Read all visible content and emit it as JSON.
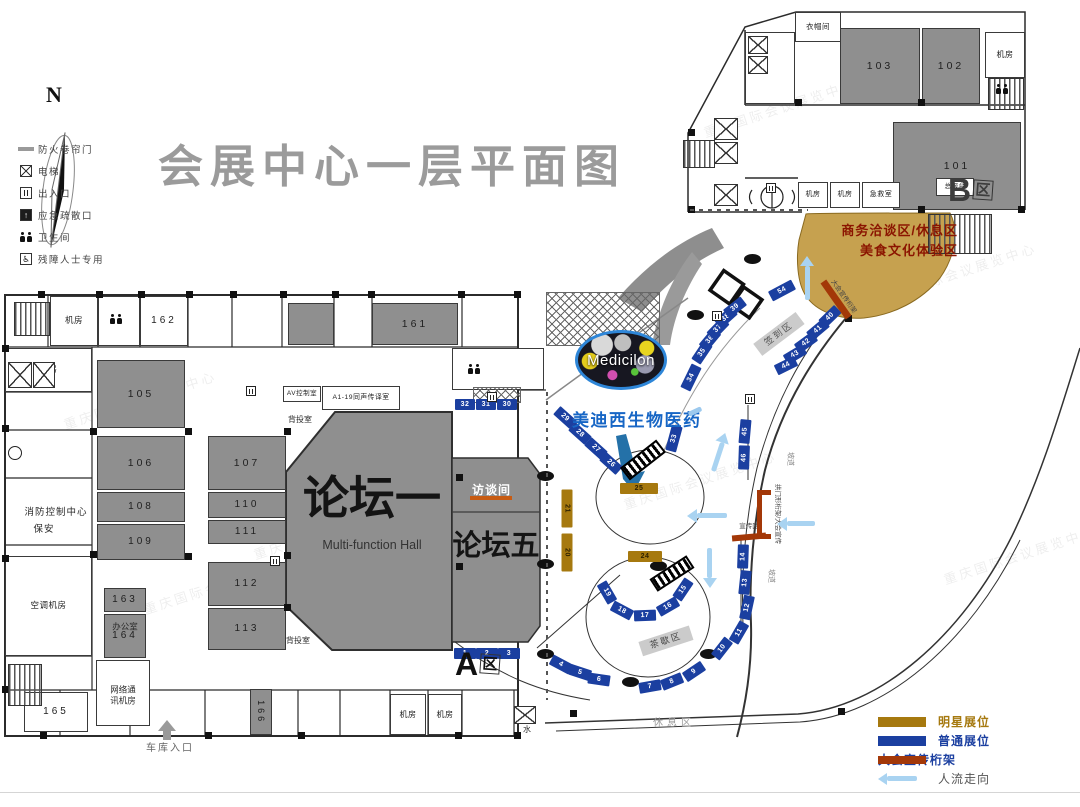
{
  "title": "会展中心一层平面图",
  "compass": {
    "label": "N"
  },
  "watermark": "重庆国际会议展览中心",
  "legend": {
    "items": [
      {
        "icon": "fire-shutter-icon",
        "label": "防火卷帘门"
      },
      {
        "icon": "elevator-icon",
        "label": "电梯"
      },
      {
        "icon": "entrance-icon",
        "label": "出入口"
      },
      {
        "icon": "emergency-exit-icon",
        "label": "应急疏散口"
      },
      {
        "icon": "restroom-icon",
        "label": "卫生间"
      },
      {
        "icon": "accessible-icon",
        "label": "残障人士专用"
      }
    ]
  },
  "booth_legend": {
    "items": [
      {
        "swatch": "star",
        "label": "明星展位"
      },
      {
        "swatch": "normal",
        "label": "普通展位"
      },
      {
        "swatch": "truss",
        "label": "大会宣传桁架"
      },
      {
        "swatch": "flow",
        "label": "人流走向"
      }
    ]
  },
  "halls": {
    "forum_one": "论坛一",
    "forum_one_en": "Multi-function Hall",
    "forum_five": "论坛五",
    "interview_room": "访谈间",
    "zone_a": "A",
    "zone_a_suffix": "区",
    "zone_b": "B",
    "zone_b_suffix": "区"
  },
  "areas": {
    "business_lounge": "商务洽谈区/休息区",
    "food_culture": "美食文化体验区"
  },
  "medicilon": {
    "logo_text": "Medicilon",
    "caption": "美迪西生物医药"
  },
  "colors": {
    "booth_normal": "#1B3FA0",
    "booth_star": "#A6790F",
    "truss_red": "#A33808",
    "flow_arrow_blue": "#A9D3F1",
    "lounge_tan": "#C6A14F",
    "room_gray": "#8F8F8F",
    "title_gray": "#9B9B9B",
    "interview_underline": "#C75B12",
    "medicilon_blue": "#1766C5",
    "lounge_text_red": "#8B1500"
  },
  "rooms": {
    "items": [
      {
        "label": "105",
        "x": 97,
        "y": 360,
        "w": 88,
        "h": 68,
        "kind": "g"
      },
      {
        "label": "106",
        "x": 97,
        "y": 436,
        "w": 88,
        "h": 54,
        "kind": "g"
      },
      {
        "label": "108",
        "x": 97,
        "y": 492,
        "w": 88,
        "h": 30,
        "kind": "g",
        "fs": 10
      },
      {
        "label": "109",
        "x": 97,
        "y": 524,
        "w": 88,
        "h": 36,
        "kind": "g",
        "fs": 10
      },
      {
        "label": "107",
        "x": 208,
        "y": 436,
        "w": 78,
        "h": 54,
        "kind": "g"
      },
      {
        "label": "110",
        "x": 208,
        "y": 492,
        "w": 78,
        "h": 26,
        "kind": "g",
        "fs": 10
      },
      {
        "label": "111",
        "x": 208,
        "y": 520,
        "w": 78,
        "h": 24,
        "kind": "g",
        "fs": 10
      },
      {
        "label": "112",
        "x": 208,
        "y": 562,
        "w": 78,
        "h": 44,
        "kind": "g",
        "fs": 10
      },
      {
        "label": "113",
        "x": 208,
        "y": 608,
        "w": 78,
        "h": 42,
        "kind": "g",
        "fs": 10
      },
      {
        "label": "161",
        "x": 372,
        "y": 303,
        "w": 86,
        "h": 42,
        "kind": "g"
      },
      {
        "label": "",
        "x": 288,
        "y": 303,
        "w": 46,
        "h": 42,
        "kind": "g"
      },
      {
        "label": "163",
        "x": 104,
        "y": 588,
        "w": 42,
        "h": 24,
        "kind": "g",
        "fs": 10
      },
      {
        "label": "164",
        "x": 104,
        "y": 614,
        "w": 42,
        "h": 44,
        "kind": "g",
        "fs": 10
      },
      {
        "label": "166",
        "x": 250,
        "y": 689,
        "w": 22,
        "h": 46,
        "kind": "g",
        "fs": 9,
        "rot": 90
      },
      {
        "label": "101",
        "x": 893,
        "y": 122,
        "w": 128,
        "h": 88,
        "kind": "g"
      },
      {
        "label": "102",
        "x": 922,
        "y": 28,
        "w": 58,
        "h": 76,
        "kind": "g"
      },
      {
        "label": "103",
        "x": 840,
        "y": 28,
        "w": 80,
        "h": 76,
        "kind": "g"
      },
      {
        "label": "",
        "x": 458,
        "y": 350,
        "w": 56,
        "h": 15,
        "kind": "g"
      },
      {
        "label": "机房",
        "x": 50,
        "y": 296,
        "w": 48,
        "h": 50,
        "kind": "w",
        "fs": 8.5
      },
      {
        "label": "",
        "x": 98,
        "y": 296,
        "w": 42,
        "h": 50,
        "kind": "w"
      },
      {
        "label": "162",
        "x": 140,
        "y": 296,
        "w": 48,
        "h": 50,
        "kind": "w",
        "fs": 10
      },
      {
        "label": "库房",
        "x": 5,
        "y": 348,
        "w": 87,
        "h": 44,
        "kind": "w",
        "fs": 8.5
      },
      {
        "label": "空调机房",
        "x": 5,
        "y": 556,
        "w": 87,
        "h": 100,
        "kind": "w",
        "fs": 8.5
      },
      {
        "label": "AV控制室",
        "x": 283,
        "y": 386,
        "w": 38,
        "h": 16,
        "kind": "w",
        "fs": 6.5
      },
      {
        "label": "A1-19同声传译室",
        "x": 322,
        "y": 386,
        "w": 78,
        "h": 24,
        "kind": "w",
        "fs": 6.8
      },
      {
        "label": "",
        "x": 96,
        "y": 660,
        "w": 54,
        "h": 66,
        "kind": "w"
      },
      {
        "label": "165",
        "x": 24,
        "y": 692,
        "w": 64,
        "h": 40,
        "kind": "w",
        "fs": 10
      },
      {
        "label": "",
        "x": 452,
        "y": 348,
        "w": 92,
        "h": 42,
        "kind": "w"
      },
      {
        "label": "衣帽间",
        "x": 795,
        "y": 12,
        "w": 46,
        "h": 30,
        "kind": "w",
        "fs": 7.5
      },
      {
        "label": "机房",
        "x": 985,
        "y": 32,
        "w": 40,
        "h": 46,
        "kind": "w",
        "fs": 8
      },
      {
        "label": "机房",
        "x": 798,
        "y": 182,
        "w": 30,
        "h": 26,
        "kind": "w",
        "fs": 7
      },
      {
        "label": "机房",
        "x": 830,
        "y": 182,
        "w": 30,
        "h": 26,
        "kind": "w",
        "fs": 7
      },
      {
        "label": "急救室",
        "x": 862,
        "y": 182,
        "w": 38,
        "h": 26,
        "kind": "w",
        "fs": 7
      },
      {
        "label": "总服台",
        "x": 936,
        "y": 178,
        "w": 38,
        "h": 18,
        "kind": "w",
        "fs": 6.5
      },
      {
        "label": "机房",
        "x": 390,
        "y": 694,
        "w": 36,
        "h": 41,
        "kind": "w",
        "fs": 8
      },
      {
        "label": "机房",
        "x": 428,
        "y": 694,
        "w": 34,
        "h": 41,
        "kind": "w",
        "fs": 8
      },
      {
        "label": "",
        "x": 745,
        "y": 32,
        "w": 50,
        "h": 72,
        "kind": "w"
      }
    ]
  },
  "labels": {
    "items": [
      {
        "text": "消防控制中心",
        "x": 56,
        "y": 513,
        "fs": 9.5,
        "ls": 1
      },
      {
        "text": "保安",
        "x": 44,
        "y": 530,
        "fs": 9.5,
        "ls": 1
      },
      {
        "text": "背投室",
        "x": 300,
        "y": 420,
        "fs": 8
      },
      {
        "text": "背投室",
        "x": 298,
        "y": 641,
        "fs": 8
      },
      {
        "text": "办公室",
        "x": 125,
        "y": 627,
        "fs": 8.5
      },
      {
        "text": "网络通讯机房",
        "x": 123,
        "y": 695,
        "fs": 8.5,
        "w": 32,
        "wrap": true
      },
      {
        "text": "水",
        "x": 527,
        "y": 730,
        "fs": 8
      },
      {
        "text": "车库入口",
        "x": 170,
        "y": 749,
        "fs": 10,
        "ls": 2,
        "color": "#666"
      },
      {
        "text": "休息区",
        "x": 674,
        "y": 724,
        "fs": 10,
        "ls": 4,
        "color": "#9a9a9a"
      },
      {
        "text": "坡道",
        "x": 789,
        "y": 459,
        "fs": 7,
        "rot": 90,
        "color": "#888"
      },
      {
        "text": "坡道",
        "x": 770,
        "y": 576,
        "fs": 7,
        "rot": 90,
        "color": "#888"
      },
      {
        "text": "拱门形桁架/大会宣传",
        "x": 777,
        "y": 514,
        "fs": 6.5,
        "rot": 90,
        "color": "#444"
      },
      {
        "text": "宣传区",
        "x": 749,
        "y": 527,
        "fs": 6.5,
        "color": "#444"
      },
      {
        "text": "大会宣传桁架",
        "x": 843,
        "y": 297,
        "fs": 6.5,
        "rot": 55,
        "color": "#444"
      },
      {
        "text": "签到区",
        "x": 779,
        "y": 334,
        "fs": 9,
        "rot": -37,
        "bg": "#CBCBCB",
        "ls": 2,
        "color": "#555"
      },
      {
        "text": "茶歇区",
        "x": 666,
        "y": 641,
        "fs": 9,
        "rot": -18,
        "bg": "#CBCBCB",
        "ls": 2,
        "color": "#444"
      }
    ]
  },
  "booths": {
    "items": [
      {
        "n": "1",
        "x": 465,
        "y": 653
      },
      {
        "n": "2",
        "x": 487,
        "y": 653
      },
      {
        "n": "3",
        "x": 509,
        "y": 653
      },
      {
        "n": "4",
        "x": 561,
        "y": 664,
        "a": 28
      },
      {
        "n": "5",
        "x": 580,
        "y": 672,
        "a": 18
      },
      {
        "n": "6",
        "x": 599,
        "y": 679,
        "a": 8
      },
      {
        "n": "7",
        "x": 650,
        "y": 686,
        "a": -10
      },
      {
        "n": "8",
        "x": 672,
        "y": 681,
        "a": -22
      },
      {
        "n": "9",
        "x": 694,
        "y": 671,
        "a": -34
      },
      {
        "n": "10",
        "x": 722,
        "y": 648,
        "a": -52
      },
      {
        "n": "11",
        "x": 739,
        "y": 632,
        "a": -60
      },
      {
        "n": "12",
        "x": 747,
        "y": 607,
        "a": -78,
        "w": 24
      },
      {
        "n": "13",
        "x": 745,
        "y": 582,
        "a": -84,
        "w": 24
      },
      {
        "n": "14",
        "x": 743,
        "y": 556,
        "a": -88,
        "w": 24
      },
      {
        "n": "15",
        "x": 683,
        "y": 589,
        "a": -56
      },
      {
        "n": "16",
        "x": 668,
        "y": 606,
        "a": -30
      },
      {
        "n": "17",
        "x": 645,
        "y": 615,
        "a": -2
      },
      {
        "n": "18",
        "x": 622,
        "y": 610,
        "a": 28
      },
      {
        "n": "19",
        "x": 607,
        "y": 592,
        "a": 60
      },
      {
        "n": "20",
        "t": "s",
        "x": 567,
        "y": 552,
        "a": 90,
        "w": 38
      },
      {
        "n": "21",
        "t": "s",
        "x": 567,
        "y": 508,
        "a": 90,
        "w": 38
      },
      {
        "n": "24",
        "t": "s",
        "x": 645,
        "y": 556,
        "w": 34
      },
      {
        "n": "25",
        "t": "s",
        "x": 639,
        "y": 488,
        "w": 38
      },
      {
        "n": "26",
        "x": 611,
        "y": 463,
        "a": 42
      },
      {
        "n": "27",
        "x": 596,
        "y": 448,
        "a": 42
      },
      {
        "n": "28",
        "x": 580,
        "y": 433,
        "a": 42
      },
      {
        "n": "29",
        "x": 565,
        "y": 417,
        "a": 42
      },
      {
        "n": "32",
        "x": 465,
        "y": 404,
        "w": 20
      },
      {
        "n": "31",
        "x": 486,
        "y": 404,
        "w": 20
      },
      {
        "n": "30",
        "x": 507,
        "y": 404,
        "w": 20
      },
      {
        "n": "33",
        "x": 674,
        "y": 438,
        "a": -75,
        "w": 26
      },
      {
        "n": "34",
        "x": 691,
        "y": 377,
        "a": -64,
        "w": 26
      },
      {
        "n": "35",
        "x": 702,
        "y": 352,
        "a": -56
      },
      {
        "n": "36",
        "x": 710,
        "y": 339,
        "a": -50
      },
      {
        "n": "37",
        "x": 718,
        "y": 328,
        "a": -46
      },
      {
        "n": "38",
        "x": 726,
        "y": 317,
        "a": -42
      },
      {
        "n": "39",
        "x": 735,
        "y": 307,
        "a": -38
      },
      {
        "n": "54",
        "x": 782,
        "y": 290,
        "a": -28,
        "w": 26
      },
      {
        "n": "40",
        "x": 830,
        "y": 316,
        "a": -44
      },
      {
        "n": "41",
        "x": 818,
        "y": 329,
        "a": -40
      },
      {
        "n": "42",
        "x": 806,
        "y": 342,
        "a": -36
      },
      {
        "n": "43",
        "x": 795,
        "y": 354,
        "a": -31
      },
      {
        "n": "44",
        "x": 786,
        "y": 365,
        "a": -26
      },
      {
        "n": "45",
        "x": 745,
        "y": 431,
        "a": -85,
        "w": 24
      },
      {
        "n": "46",
        "x": 744,
        "y": 457,
        "a": -88,
        "w": 24
      }
    ]
  },
  "shapes": {
    "columns": [
      [
        38,
        291
      ],
      [
        96,
        291
      ],
      [
        138,
        291
      ],
      [
        186,
        291
      ],
      [
        230,
        291
      ],
      [
        280,
        291
      ],
      [
        332,
        291
      ],
      [
        368,
        291
      ],
      [
        458,
        291
      ],
      [
        514,
        291
      ],
      [
        2,
        345
      ],
      [
        2,
        425
      ],
      [
        2,
        555
      ],
      [
        2,
        686
      ],
      [
        90,
        428
      ],
      [
        90,
        551
      ],
      [
        185,
        428
      ],
      [
        185,
        553
      ],
      [
        284,
        428
      ],
      [
        284,
        552
      ],
      [
        284,
        604
      ],
      [
        40,
        732
      ],
      [
        205,
        732
      ],
      [
        298,
        732
      ],
      [
        455,
        732
      ],
      [
        514,
        732
      ],
      [
        688,
        129
      ],
      [
        688,
        206
      ],
      [
        795,
        99
      ],
      [
        918,
        99
      ],
      [
        918,
        206
      ],
      [
        1018,
        206
      ],
      [
        845,
        315
      ],
      [
        650,
        342
      ],
      [
        570,
        710
      ],
      [
        838,
        708
      ],
      [
        456,
        474
      ],
      [
        456,
        563
      ]
    ],
    "ovals": [
      [
        545,
        476
      ],
      [
        545,
        564
      ],
      [
        545,
        654
      ],
      [
        630,
        682
      ],
      [
        708,
        654
      ],
      [
        658,
        566
      ],
      [
        752,
        259
      ],
      [
        695,
        315
      ]
    ],
    "stairs": [
      [
        14,
        302,
        34,
        32
      ],
      [
        8,
        664,
        32,
        40
      ],
      [
        683,
        140,
        30,
        26
      ],
      [
        928,
        214,
        62,
        38
      ],
      [
        988,
        78,
        34,
        30
      ]
    ],
    "elevators": [
      [
        8,
        362,
        22,
        24
      ],
      [
        33,
        362,
        20,
        24
      ],
      [
        714,
        118,
        22,
        20
      ],
      [
        714,
        142,
        22,
        20
      ],
      [
        714,
        184,
        22,
        20
      ],
      [
        748,
        36,
        18,
        16
      ],
      [
        748,
        56,
        18,
        16
      ],
      [
        514,
        706,
        20,
        16
      ]
    ],
    "doors": [
      [
        712,
        311
      ],
      [
        766,
        183
      ],
      [
        745,
        394
      ],
      [
        487,
        392
      ],
      [
        270,
        556
      ],
      [
        246,
        386
      ]
    ],
    "wc": [
      [
        110,
        314
      ],
      [
        468,
        364
      ],
      [
        996,
        84
      ]
    ],
    "dashes_v": [
      [
        546,
        392,
        308
      ]
    ],
    "dashes_h": [
      [
        690,
        209,
        118
      ]
    ],
    "hatches": [
      [
        546,
        292,
        112,
        52
      ],
      [
        473,
        387,
        46,
        14
      ]
    ],
    "escalators": [
      [
        620,
        452,
        46,
        16,
        -38
      ],
      [
        650,
        566,
        44,
        15,
        -33
      ]
    ],
    "trusses": [
      [
        836,
        299,
        44,
        7,
        55
      ],
      [
        749,
        537,
        34,
        6,
        -5
      ],
      [
        759,
        514,
        5,
        48,
        0
      ],
      [
        764,
        492,
        14,
        5,
        0
      ],
      [
        764,
        536,
        14,
        5,
        0
      ]
    ],
    "arrows": [
      [
        802,
        278,
        -90,
        34
      ],
      [
        714,
        452,
        -72,
        30
      ],
      [
        702,
        516,
        180,
        30
      ],
      [
        705,
        568,
        90,
        30
      ],
      [
        791,
        524,
        180,
        28
      ]
    ],
    "watermarks": [
      [
        60,
        390
      ],
      [
        140,
        575
      ],
      [
        700,
        98
      ],
      [
        880,
        262
      ],
      [
        620,
        470
      ],
      [
        250,
        520
      ],
      [
        940,
        545
      ]
    ]
  }
}
